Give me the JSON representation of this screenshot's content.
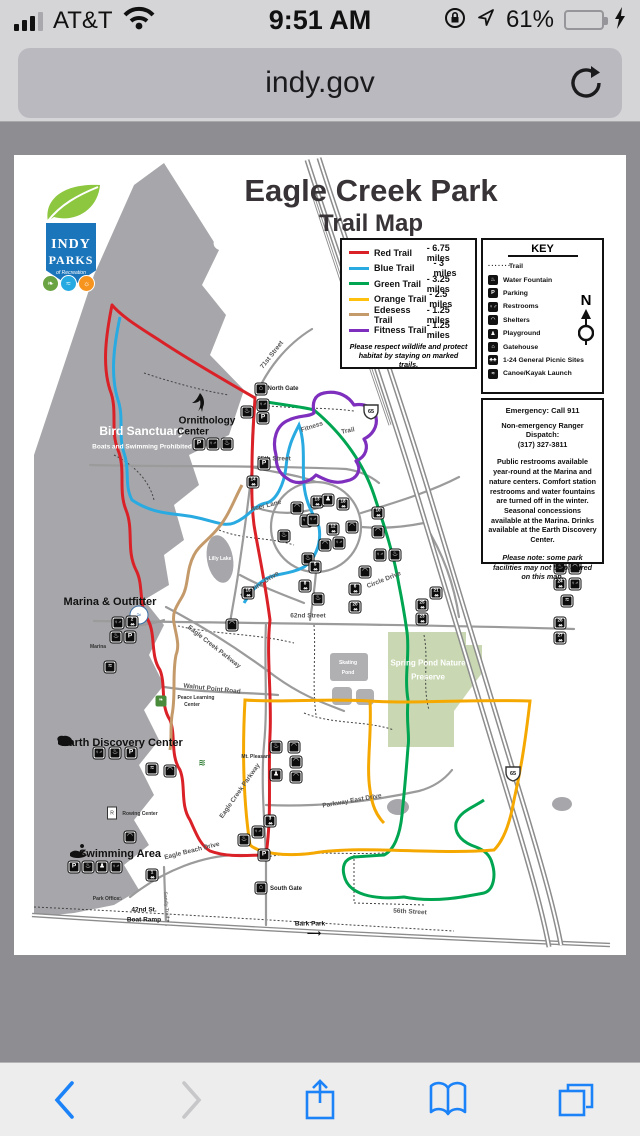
{
  "status_bar": {
    "carrier": "AT&T",
    "time": "9:51 AM",
    "battery_pct": "61%"
  },
  "url_bar": {
    "url": "indy.gov"
  },
  "page": {
    "logo": {
      "top": "INDY",
      "mid": "PARKS",
      "script": "of Recreation"
    },
    "title": "Eagle Creek Park",
    "subtitle": "Trail Map",
    "legend": {
      "rows": [
        {
          "name": "Red Trail",
          "miles": "- 6.75 miles",
          "color": "#da2128"
        },
        {
          "name": "Blue Trail",
          "miles": "- 3 miles",
          "color": "#29aae1"
        },
        {
          "name": "Green Trail",
          "miles": "- 3.25 miles",
          "color": "#00a551"
        },
        {
          "name": "Orange Trail",
          "miles": "- 2.5 miles",
          "color": "#ffc10e"
        },
        {
          "name": "Edesess Trail",
          "miles": "- 1.25 miles",
          "color": "#c49a6b"
        },
        {
          "name": "Fitness Trail",
          "miles": "- 1.25 miles",
          "color": "#7e2fbe"
        }
      ],
      "note1": "Please respect wildlife and protect",
      "note2": "habitat by staying on marked trails."
    },
    "key": {
      "title": "KEY",
      "north_label": "N",
      "items": [
        {
          "t": "trail",
          "label": "Trail"
        },
        {
          "t": "wf",
          "label": "Water Fountain"
        },
        {
          "t": "P",
          "label": "Parking"
        },
        {
          "t": "wc",
          "label": "Restrooms"
        },
        {
          "t": "shelter",
          "label": "Shelters"
        },
        {
          "t": "play",
          "label": "Playground"
        },
        {
          "t": "gate",
          "label": "Gatehouse"
        },
        {
          "t": "pic",
          "label": "1-24 General  Picnic Sites"
        },
        {
          "t": "canoe",
          "label": "Canoe/Kayak Launch"
        }
      ]
    },
    "info": {
      "l1": "Emergency: Call 911",
      "l2": "Non-emergency Ranger Dispatch:",
      "l3": "(317) 327-3811",
      "p1": "Public restrooms available year-round at the Marina and nature centers. Comfort station restrooms and water fountains are turned off in the winter. Seasonal concessions available at the Marina. Drinks available at the Earth Discovery Center.",
      "p2": "Please note: some park facilities may not be pictured on this map."
    },
    "map_labels": [
      {
        "t": "Bird Sanctuary",
        "x": 128,
        "y": 276,
        "c": "wb"
      },
      {
        "t": "Boats and Swimming Prohibited",
        "x": 128,
        "y": 292,
        "c": "ws"
      },
      {
        "t": "Ornithology",
        "x": 193,
        "y": 266,
        "c": "bb"
      },
      {
        "t": "Center",
        "x": 179,
        "y": 277,
        "c": "bb"
      },
      {
        "t": "Marina & Outfitter",
        "x": 96,
        "y": 447,
        "c": "bb11"
      },
      {
        "t": "Marina",
        "x": 84,
        "y": 492,
        "c": "t5"
      },
      {
        "t": "Earth Discovery Center",
        "x": 108,
        "y": 588,
        "c": "bb11"
      },
      {
        "t": "Swimming Area",
        "x": 106,
        "y": 699,
        "c": "bb11"
      },
      {
        "t": "North Gate",
        "x": 269,
        "y": 234,
        "c": "t6"
      },
      {
        "t": "South Gate",
        "x": 272,
        "y": 734,
        "c": "t6"
      },
      {
        "t": "Park Office",
        "x": 92,
        "y": 744,
        "c": "t5"
      },
      {
        "t": "Rowing Center",
        "x": 126,
        "y": 659,
        "c": "t5"
      },
      {
        "t": "Peace Learning",
        "x": 182,
        "y": 543,
        "c": "t5"
      },
      {
        "t": "Center",
        "x": 178,
        "y": 550,
        "c": "t5"
      },
      {
        "t": "Mt. Pleasant",
        "x": 242,
        "y": 602,
        "c": "t5"
      },
      {
        "t": "Lilly Lake",
        "x": 206,
        "y": 404,
        "c": "wt5"
      },
      {
        "t": "Skating",
        "x": 334,
        "y": 508,
        "c": "wt5"
      },
      {
        "t": "Pond",
        "x": 334,
        "y": 518,
        "c": "wt5"
      },
      {
        "t": "Spring Pond Nature",
        "x": 414,
        "y": 508,
        "c": "wpb"
      },
      {
        "t": "Preserve",
        "x": 414,
        "y": 522,
        "c": "wpb"
      },
      {
        "t": "71st Street",
        "x": 258,
        "y": 200,
        "c": "road",
        "r": -52
      },
      {
        "t": "65th Street",
        "x": 260,
        "y": 304,
        "c": "road"
      },
      {
        "t": "Acer Lane",
        "x": 252,
        "y": 351,
        "c": "road",
        "r": -14
      },
      {
        "t": "Circle Drive",
        "x": 370,
        "y": 425,
        "c": "road",
        "r": -22
      },
      {
        "t": "Big Pine Drive",
        "x": 246,
        "y": 430,
        "c": "road",
        "r": -33
      },
      {
        "t": "62nd Street",
        "x": 294,
        "y": 461,
        "c": "road"
      },
      {
        "t": "Eagle Creek Parkway",
        "x": 200,
        "y": 492,
        "c": "road",
        "r": 38
      },
      {
        "t": "Walnut Point Road",
        "x": 198,
        "y": 534,
        "c": "road",
        "r": 6
      },
      {
        "t": "Eagle Creek Parkway",
        "x": 226,
        "y": 636,
        "c": "road",
        "r": -55
      },
      {
        "t": "Parkway East Drive",
        "x": 338,
        "y": 646,
        "c": "road",
        "r": -10
      },
      {
        "t": "Eagle Beach Drive",
        "x": 178,
        "y": 696,
        "c": "road",
        "r": -14
      },
      {
        "t": "56th Street",
        "x": 396,
        "y": 757,
        "c": "road",
        "r": 3
      },
      {
        "t": "Sandy Trail",
        "x": 152,
        "y": 750,
        "c": "road5",
        "r": 85
      },
      {
        "t": "Bark Park",
        "x": 296,
        "y": 769,
        "c": "t6b"
      },
      {
        "t": "42nd St.",
        "x": 130,
        "y": 755,
        "c": "t6b"
      },
      {
        "t": "Boat Ramp",
        "x": 130,
        "y": 765,
        "c": "t6b"
      },
      {
        "t": "↓",
        "x": 154,
        "y": 764,
        "c": "arr"
      },
      {
        "t": "⟶",
        "x": 300,
        "y": 779,
        "c": "arr"
      },
      {
        "t": "Fitness",
        "x": 298,
        "y": 272,
        "c": "road",
        "r": -18
      },
      {
        "t": "Trail",
        "x": 334,
        "y": 276,
        "c": "road",
        "r": -12
      }
    ],
    "map_icons": [
      {
        "t": "gate",
        "x": 247,
        "y": 234
      },
      {
        "t": "wc",
        "x": 249,
        "y": 250
      },
      {
        "t": "wf",
        "x": 233,
        "y": 257
      },
      {
        "t": "P",
        "x": 249,
        "y": 263
      },
      {
        "t": "P",
        "x": 250,
        "y": 309
      },
      {
        "t": "pic",
        "x": 239,
        "y": 327,
        "n": "14"
      },
      {
        "t": "P",
        "x": 185,
        "y": 289
      },
      {
        "t": "wc",
        "x": 199,
        "y": 289
      },
      {
        "t": "wf",
        "x": 213,
        "y": 289
      },
      {
        "t": "shelter",
        "x": 283,
        "y": 353
      },
      {
        "t": "pic",
        "x": 303,
        "y": 347,
        "n": "13"
      },
      {
        "t": "wc",
        "x": 292,
        "y": 366
      },
      {
        "t": "wf",
        "x": 270,
        "y": 381
      },
      {
        "t": "pic",
        "x": 319,
        "y": 374,
        "n": "12"
      },
      {
        "t": "shelter",
        "x": 338,
        "y": 372
      },
      {
        "t": "play",
        "x": 314,
        "y": 345
      },
      {
        "t": "pic",
        "x": 329,
        "y": 349,
        "n": "18"
      },
      {
        "t": "pic",
        "x": 364,
        "y": 358,
        "n": "10"
      },
      {
        "t": "shelter",
        "x": 364,
        "y": 377
      },
      {
        "t": "wc",
        "x": 366,
        "y": 400
      },
      {
        "t": "wf",
        "x": 381,
        "y": 400
      },
      {
        "t": "shelter",
        "x": 351,
        "y": 417
      },
      {
        "t": "wc",
        "x": 299,
        "y": 365
      },
      {
        "t": "shelter",
        "x": 311,
        "y": 390
      },
      {
        "t": "wc",
        "x": 325,
        "y": 388
      },
      {
        "t": "wf",
        "x": 294,
        "y": 404
      },
      {
        "t": "pic",
        "x": 301,
        "y": 412,
        "n": "5"
      },
      {
        "t": "pic",
        "x": 291,
        "y": 431,
        "n": "8"
      },
      {
        "t": "wf",
        "x": 304,
        "y": 444
      },
      {
        "t": "pic",
        "x": 341,
        "y": 434,
        "n": "6"
      },
      {
        "t": "pic",
        "x": 341,
        "y": 452,
        "n": "20"
      },
      {
        "t": "pic",
        "x": 408,
        "y": 450,
        "n": "25"
      },
      {
        "t": "pic",
        "x": 408,
        "y": 464,
        "n": "23"
      },
      {
        "t": "pic",
        "x": 422,
        "y": 438,
        "n": "21"
      },
      {
        "t": "wf",
        "x": 546,
        "y": 413
      },
      {
        "t": "shelter",
        "x": 561,
        "y": 413
      },
      {
        "t": "pic",
        "x": 546,
        "y": 429,
        "n": "24"
      },
      {
        "t": "wc",
        "x": 561,
        "y": 429
      },
      {
        "t": "canoe",
        "x": 553,
        "y": 446
      },
      {
        "t": "pic",
        "x": 546,
        "y": 468,
        "n": "26"
      },
      {
        "t": "pic",
        "x": 546,
        "y": 483,
        "n": "27"
      },
      {
        "t": "pic",
        "x": 234,
        "y": 438,
        "n": "15"
      },
      {
        "t": "shelter",
        "x": 218,
        "y": 470
      },
      {
        "t": "wc",
        "x": 104,
        "y": 468
      },
      {
        "t": "pic",
        "x": 118,
        "y": 467,
        "n": "2"
      },
      {
        "t": "wf",
        "x": 102,
        "y": 482
      },
      {
        "t": "P",
        "x": 116,
        "y": 482
      },
      {
        "t": "canoe",
        "x": 96,
        "y": 512
      },
      {
        "t": "wc",
        "x": 85,
        "y": 598
      },
      {
        "t": "wf",
        "x": 101,
        "y": 598
      },
      {
        "t": "P",
        "x": 117,
        "y": 598
      },
      {
        "t": "canoe",
        "x": 138,
        "y": 614
      },
      {
        "t": "shelter",
        "x": 156,
        "y": 616
      },
      {
        "t": "wf",
        "x": 262,
        "y": 592
      },
      {
        "t": "shelter",
        "x": 280,
        "y": 592
      },
      {
        "t": "shelter",
        "x": 282,
        "y": 607
      },
      {
        "t": "play",
        "x": 262,
        "y": 620
      },
      {
        "t": "shelter",
        "x": 282,
        "y": 622
      },
      {
        "t": "pic",
        "x": 256,
        "y": 666,
        "n": "3"
      },
      {
        "t": "wc",
        "x": 244,
        "y": 677
      },
      {
        "t": "wf",
        "x": 230,
        "y": 685
      },
      {
        "t": "P",
        "x": 250,
        "y": 700
      },
      {
        "t": "gate",
        "x": 247,
        "y": 733
      },
      {
        "t": "shelter",
        "x": 116,
        "y": 682
      },
      {
        "t": "P",
        "x": 60,
        "y": 712
      },
      {
        "t": "wf",
        "x": 74,
        "y": 712
      },
      {
        "t": "play",
        "x": 88,
        "y": 712
      },
      {
        "t": "wc",
        "x": 102,
        "y": 712
      },
      {
        "t": "pic",
        "x": 138,
        "y": 720,
        "n": "1"
      }
    ]
  },
  "toolbar": {
    "back": "back",
    "forward": "forward",
    "share": "share",
    "bookmarks": "bookmarks",
    "tabs": "tabs"
  }
}
